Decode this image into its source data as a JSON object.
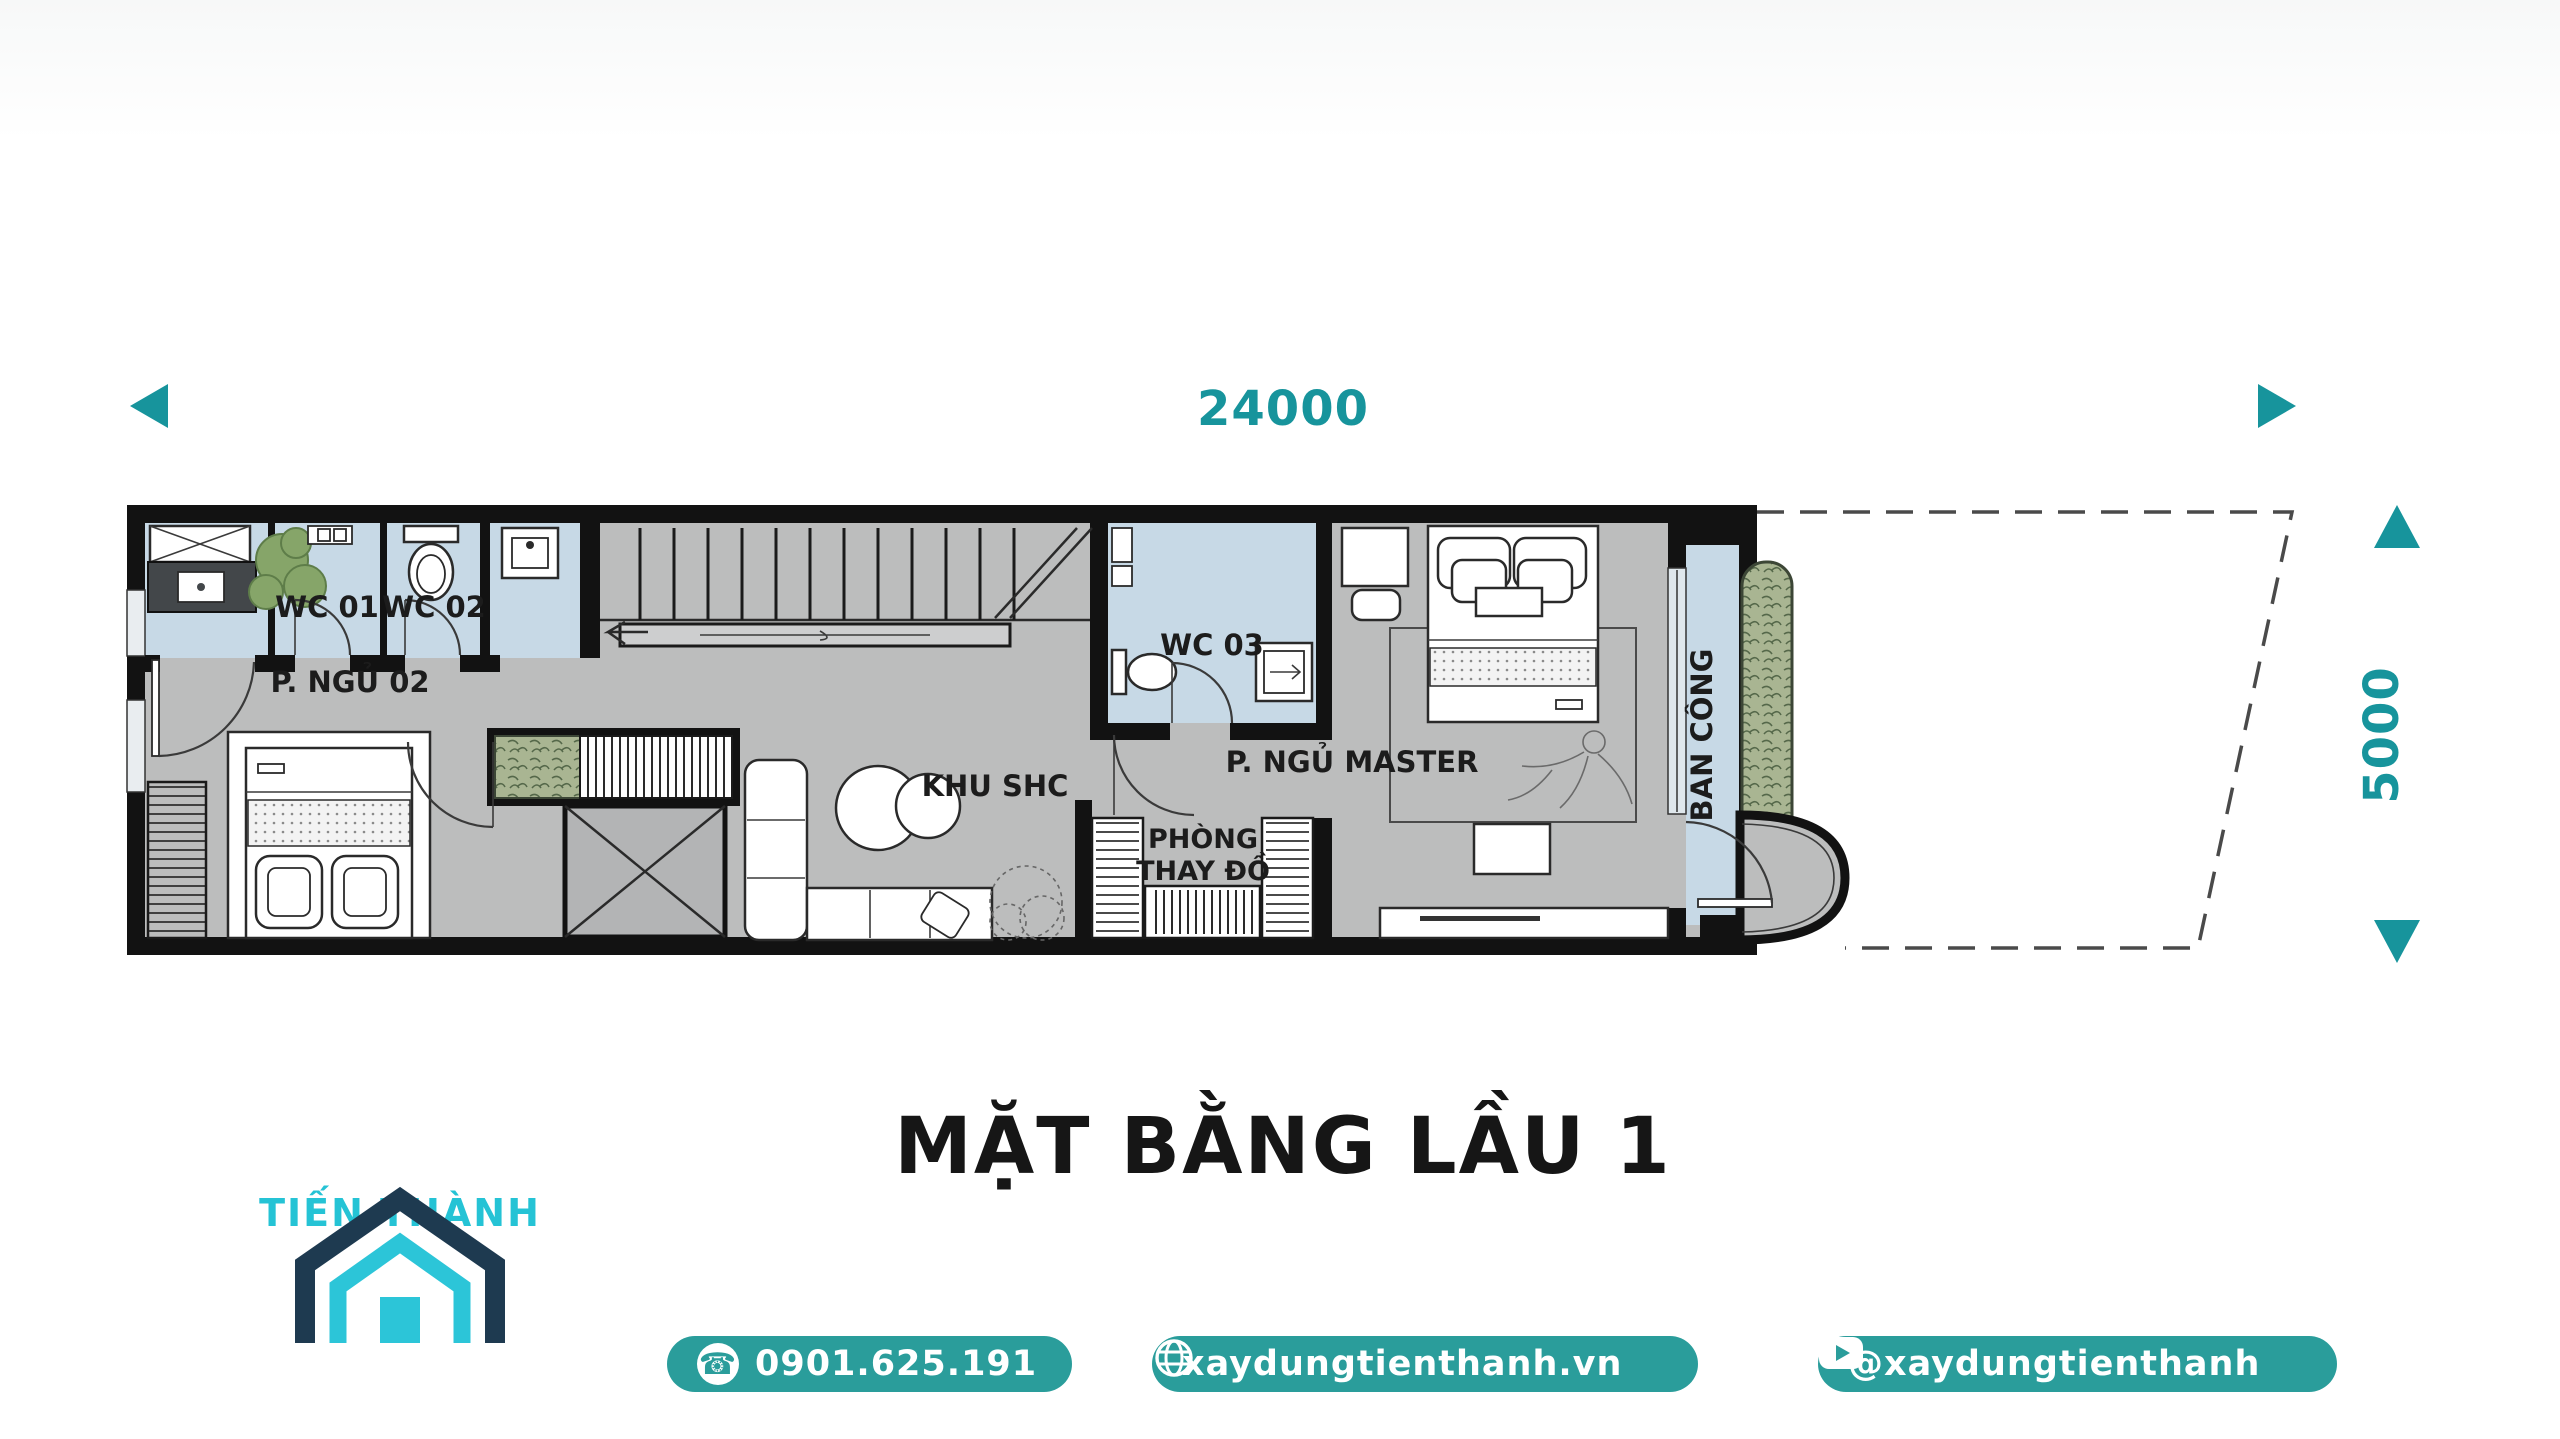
{
  "dimension_width": {
    "label": "24000"
  },
  "dimension_height": {
    "label": "5000"
  },
  "plan": {
    "rooms": {
      "wc01": "WC 01",
      "wc02": "WC 02",
      "wc03": "WC 03",
      "bedroom02": "P. NGỦ 02",
      "living": "KHU SHC",
      "dressing_line1": "PHÒNG",
      "dressing_line2": "THAY ĐỒ",
      "master": "P. NGỦ MASTER",
      "balcony": "BAN CÔNG"
    }
  },
  "title": "MẶT BẰNG LẦU 1",
  "brand": {
    "name": "TIẾN THÀNH"
  },
  "footer": {
    "phone": "0901.625.191",
    "website": "xaydungtienthanh.vn",
    "social_handle": "@xaydungtienthanh"
  },
  "colors": {
    "accent_teal": "#17949c",
    "pill_teal": "#2a9d9b",
    "logo_navy": "#1e3a50",
    "logo_cyan": "#2cc5d8",
    "floor_gray": "#bcbdbd",
    "wet_blue": "#c7d9e6",
    "wall_black": "#121212",
    "planter_green": "#a9b592"
  }
}
